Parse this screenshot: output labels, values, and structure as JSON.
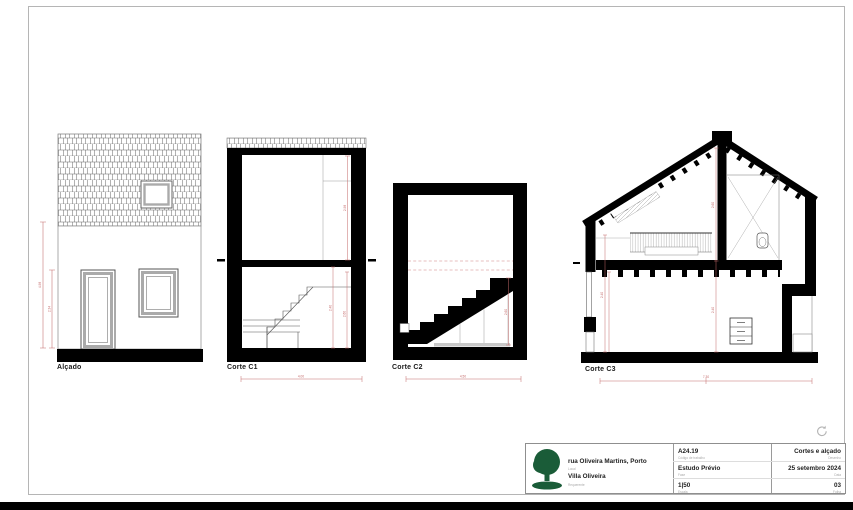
{
  "sheet": {
    "drawings": [
      {
        "id": "alcado",
        "label": "Alçado"
      },
      {
        "id": "corte-c1",
        "label": "Corte C1"
      },
      {
        "id": "corte-c2",
        "label": "Corte C2"
      },
      {
        "id": "corte-c3",
        "label": "Corte C3"
      }
    ]
  },
  "dims": {
    "alcado_total": "4.98",
    "alcado_door": "2.34",
    "c1_upper": "2.98",
    "c1_lower_a": "2.40",
    "c1_lower_b": "2.60",
    "c1_width": "4.00",
    "c2_stair": "2.60",
    "c2_width": "4.50",
    "c3_upper": "2.60",
    "c3_lower": "2.40",
    "c3_left": "2.40",
    "c3_width": "7.30"
  },
  "title_block": {
    "address": "rua Oliveira Martins, Porto",
    "address_label": "Local",
    "project": "Villa Oliveira",
    "project_label": "Requerente",
    "code": "A24.19",
    "code_label": "Código de trabalho",
    "phase": "Estudo Prévio",
    "phase_label": "Fase",
    "scale": "1|50",
    "scale_label": "Escala",
    "sheet_title": "Cortes e alçado",
    "sheet_title_label": "Desenho",
    "date": "25 setembro 2024",
    "date_label": "Data",
    "number": "03",
    "number_label": "Folha"
  },
  "colors": {
    "dim_red": "#c46a6a",
    "logo_green": "#1a5c38",
    "line_black": "#000000",
    "frame_grey": "#aaaaaa"
  }
}
